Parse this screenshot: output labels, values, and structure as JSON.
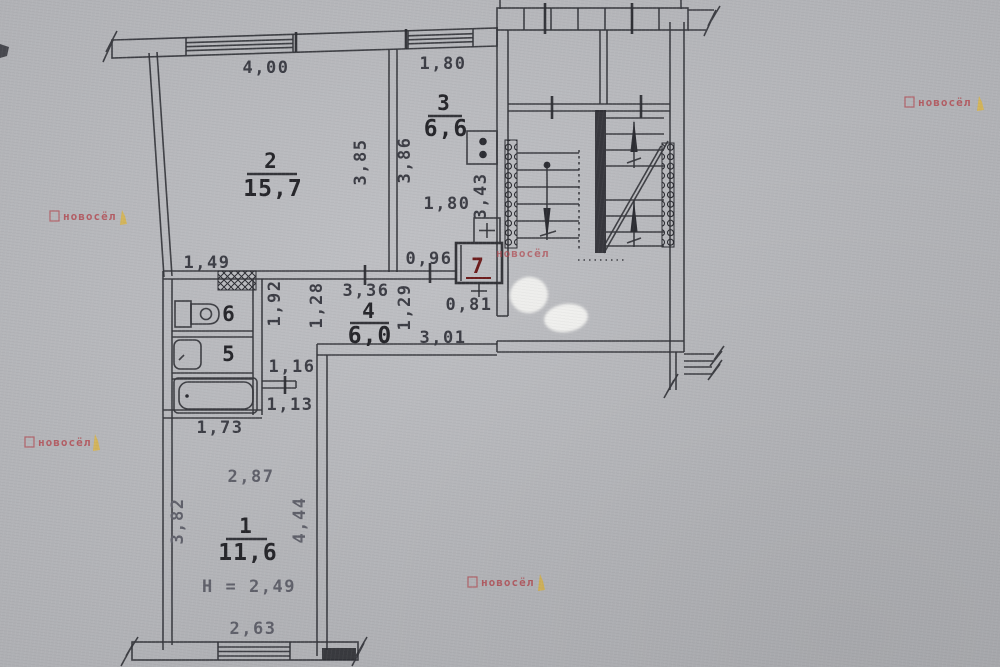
{
  "document": {
    "kind": "scanned apartment floor plan with stairwell",
    "palette": {
      "paper": "#b5b6ba",
      "ink": "#2c2d33",
      "watermark_red": "#b2424a",
      "watermark_yellow": "#d8b44a",
      "room7_red": "#6e1d1d",
      "correction_blob": "#f1f1ef"
    }
  },
  "watermark": {
    "text": "новосёл",
    "icon": "gnome-icon"
  },
  "rooms": {
    "r1": {
      "number": "1",
      "area": "11,6",
      "height_note": "Н = 2,49"
    },
    "r2": {
      "number": "2",
      "area": "15,7"
    },
    "r3": {
      "number": "3",
      "area": "6,6"
    },
    "r4": {
      "number": "4",
      "area": "6,0"
    },
    "r5": {
      "number": "5"
    },
    "r6": {
      "number": "6"
    },
    "r7": {
      "number": "7"
    }
  },
  "dims": {
    "d400": "4,00",
    "d180_top": "1,80",
    "d385": "3,85",
    "d386": "3,86",
    "d343": "3,43",
    "d180_mid": "1,80",
    "d096": "0,96",
    "d149": "1,49",
    "d336": "3,36",
    "d192": "1,92",
    "d128": "1,28",
    "d129": "1,29",
    "d081": "0,81",
    "d301": "3,01",
    "d116": "1,16",
    "d113": "1,13",
    "d173": "1,73",
    "d287": "2,87",
    "d382": "3,82",
    "d444": "4,44",
    "d263": "2,63"
  }
}
